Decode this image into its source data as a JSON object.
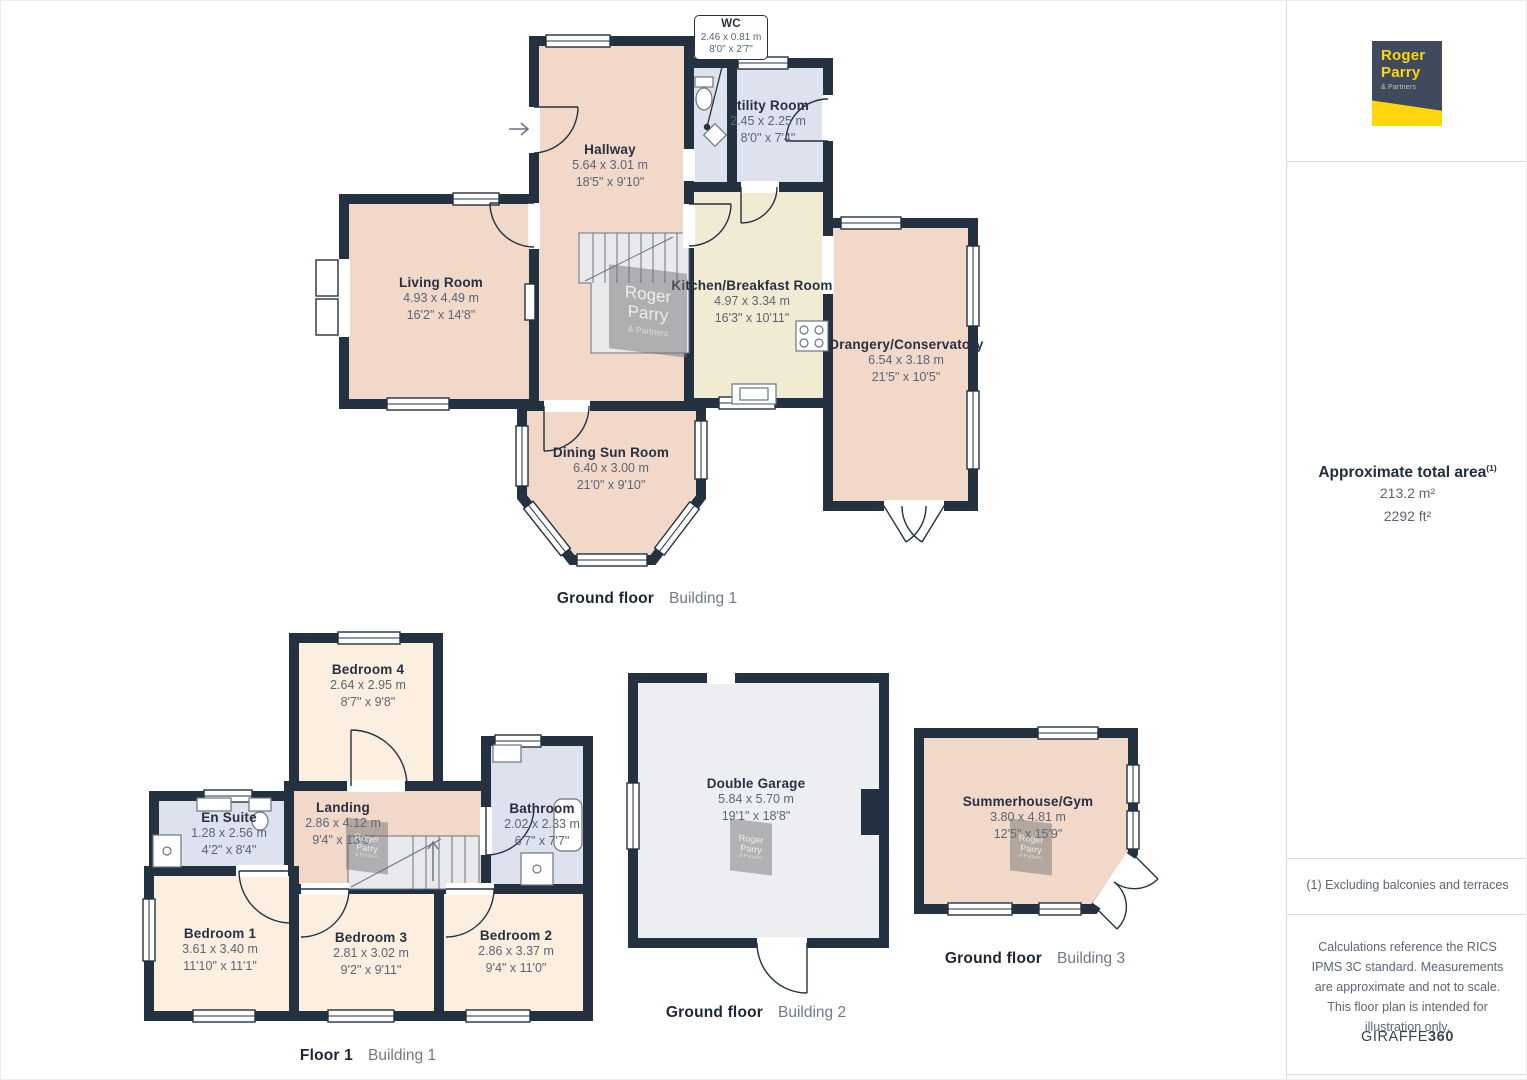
{
  "rooms": {
    "wc": {
      "name": "WC",
      "metric": "2.46 x 0.81 m",
      "imperial": "8'0\" x 2'7\""
    },
    "utility": {
      "name": "Utility Room",
      "metric": "2.45 x 2.25 m",
      "imperial": "8'0\" x 7'4\""
    },
    "hallway": {
      "name": "Hallway",
      "metric": "5.64 x 3.01 m",
      "imperial": "18'5\" x 9'10\""
    },
    "living": {
      "name": "Living Room",
      "metric": "4.93 x 4.49 m",
      "imperial": "16'2\" x 14'8\""
    },
    "kitchen": {
      "name": "Kitchen/Breakfast Room",
      "metric": "4.97 x 3.34 m",
      "imperial": "16'3\" x 10'11\""
    },
    "orangery": {
      "name": "Orangery/Conservatory",
      "metric": "6.54 x 3.18 m",
      "imperial": "21'5\" x 10'5\""
    },
    "dining": {
      "name": "Dining Sun Room",
      "metric": "6.40 x 3.00 m",
      "imperial": "21'0\" x 9'10\""
    },
    "bedroom4": {
      "name": "Bedroom 4",
      "metric": "2.64 x 2.95 m",
      "imperial": "8'7\" x 9'8\""
    },
    "landing": {
      "name": "Landing",
      "metric": "2.86 x 4.12 m",
      "imperial": "9'4\" x 13'6\""
    },
    "bathroom": {
      "name": "Bathroom",
      "metric": "2.02 x 2.33 m",
      "imperial": "6'7\" x 7'7\""
    },
    "ensuite": {
      "name": "En Suite",
      "metric": "1.28 x 2.56 m",
      "imperial": "4'2\" x 8'4\""
    },
    "bedroom1": {
      "name": "Bedroom 1",
      "metric": "3.61 x 3.40 m",
      "imperial": "11'10\" x 11'1\""
    },
    "bedroom3": {
      "name": "Bedroom 3",
      "metric": "2.81 x 3.02 m",
      "imperial": "9'2\" x 9'11\""
    },
    "bedroom2": {
      "name": "Bedroom 2",
      "metric": "2.86 x 3.37 m",
      "imperial": "9'4\" x 11'0\""
    },
    "garage": {
      "name": "Double Garage",
      "metric": "5.84 x 5.70 m",
      "imperial": "19'1\" x 18'8\""
    },
    "summerhouse": {
      "name": "Summerhouse/Gym",
      "metric": "3.80 x 4.81 m",
      "imperial": "12'5\" x 15'9\""
    }
  },
  "floors": [
    {
      "caption": "Ground floor",
      "building": "Building 1"
    },
    {
      "caption": "Floor 1",
      "building": "Building 1"
    },
    {
      "caption": "Ground floor",
      "building": "Building 2"
    },
    {
      "caption": "Ground floor",
      "building": "Building 3"
    }
  ],
  "watermark": {
    "line1": "Roger",
    "line2": "Parry",
    "line3": "& Partners"
  },
  "sidebar": {
    "logo": {
      "line1": "Roger",
      "line2": "Parry",
      "line3": "& Partners"
    },
    "area": {
      "title": "Approximate total area",
      "superscript": "(1)",
      "metric": "213.2 m²",
      "imperial": "2292 ft²"
    },
    "footnote": "(1) Excluding balconies and terraces",
    "disclaimer": "Calculations reference the RICS IPMS 3C standard. Measurements are approximate and not to scale. This floor plan is intended for illustration only.",
    "brand": {
      "name": "GIRAFFE",
      "suffix": "360"
    }
  },
  "colors": {
    "wall": "#233140",
    "room-pink": "#f2d8c9",
    "room-cream": "#fcefdf",
    "room-kitchen": "#f1ebd4",
    "room-wet": "#dde2ee",
    "room-garage": "#eceef1",
    "stair-grey": "#e8e9eb",
    "brand-navy": "#3f4a5d",
    "brand-yellow": "#ffd60b",
    "text-dark": "#273142",
    "text-grey": "#5c6573",
    "caption-grey": "#6f7987",
    "divider": "#dcdcdc"
  }
}
